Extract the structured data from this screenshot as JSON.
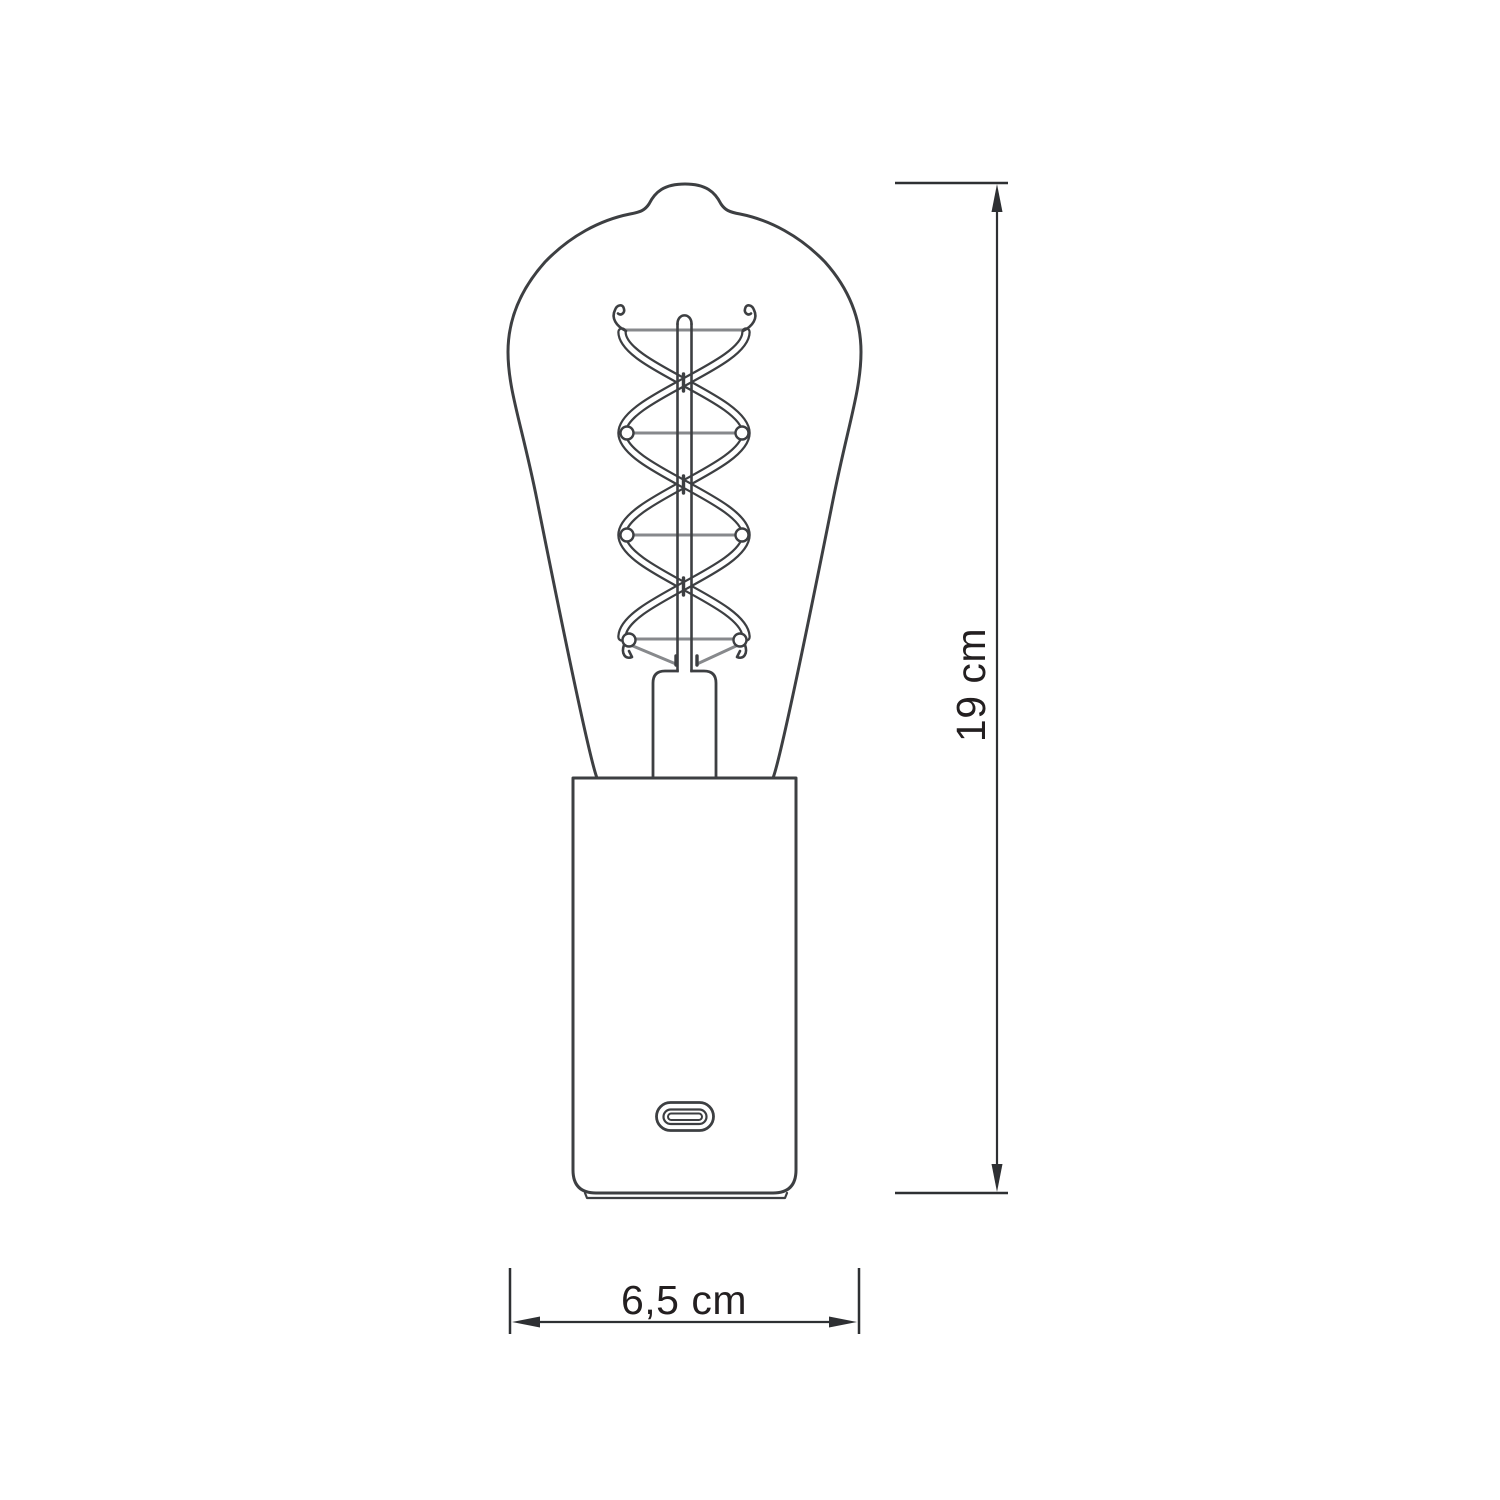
{
  "diagram": {
    "type": "technical-dimension-drawing",
    "subject": "Edison ST64 spiral-filament bulb lamp on cylindrical base with USB-C port",
    "dimensions": {
      "height_label": "19 cm",
      "width_label": "6,5 cm"
    },
    "parts": [
      "bulb-glass",
      "spiral-filament",
      "filament-support-wires",
      "glass-stem-mount",
      "stem-rod",
      "cylindrical-base",
      "usb-c-port",
      "base-foot"
    ],
    "colors": {
      "outline": "#3d3f42",
      "wire": "#87898c",
      "dimension": "#2e3033",
      "text": "#231f20",
      "background": "#ffffff"
    }
  }
}
